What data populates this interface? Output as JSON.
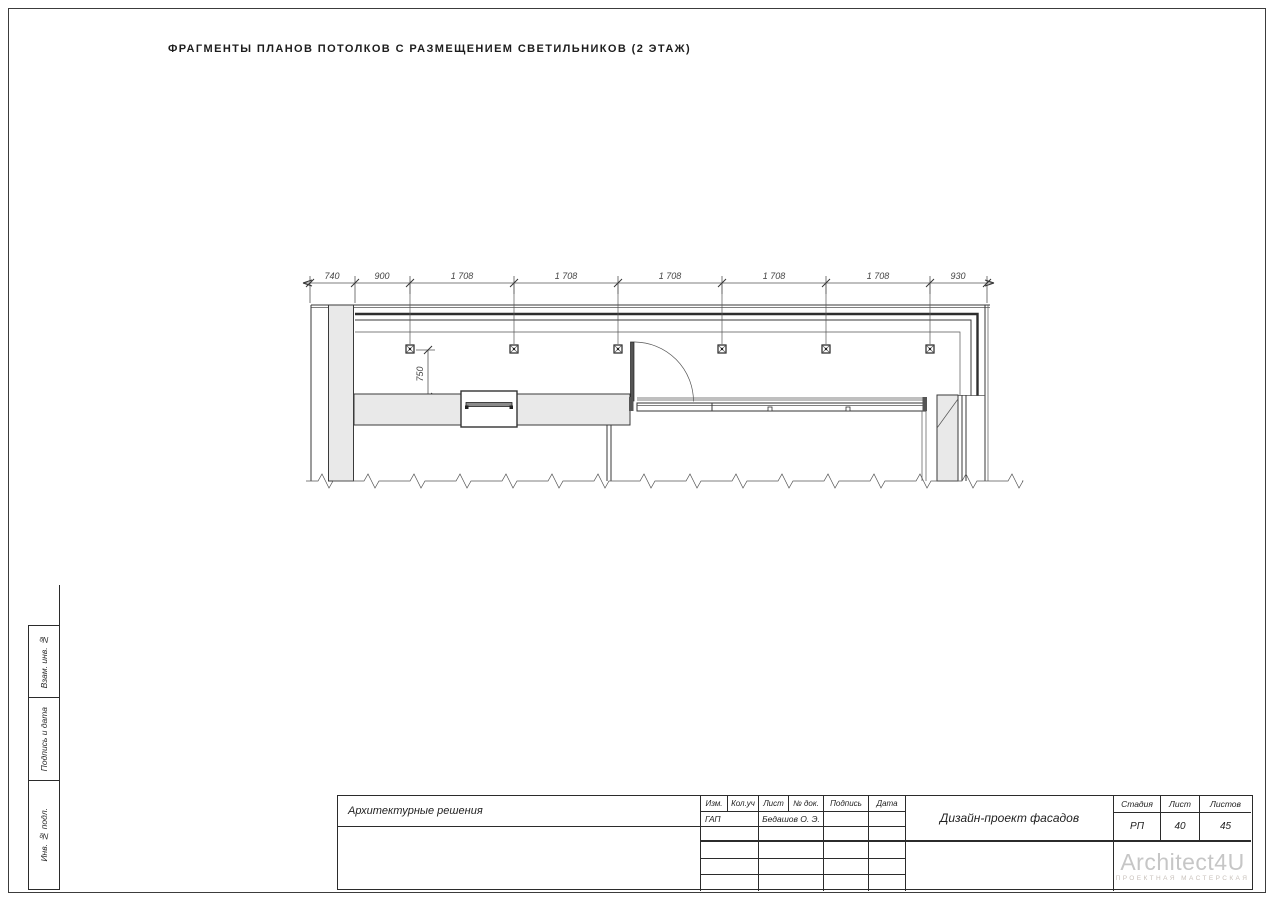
{
  "sheet": {
    "title": "ФРАГМЕНТЫ ПЛАНОВ ПОТОЛКОВ С РАЗМЕЩЕНИЕМ СВЕТИЛЬНИКОВ (2 ЭТАЖ)"
  },
  "drawing": {
    "dims_h": [
      "740",
      "900",
      "1 708",
      "1 708",
      "1 708",
      "1 708",
      "1 708",
      "930"
    ],
    "dim_v": "750",
    "light_fixture_count": 6
  },
  "side_stamp": {
    "labels": [
      "Взам. инв. №",
      "Подпись и дата",
      "Инв. № подл."
    ]
  },
  "title_block": {
    "section": "Архитектурные решения",
    "cols": [
      "Изм.",
      "Кол.уч",
      "Лист",
      "№ док.",
      "Подпись",
      "Дата"
    ],
    "role": "ГАП",
    "name": "Бедашов О. Э.",
    "project": "Дизайн-проект фасадов",
    "stage_h": "Стадия",
    "list_h": "Лист",
    "listov_h": "Листов",
    "stage": "РП",
    "list": "40",
    "listov": "45",
    "logo_name": "Architect4U",
    "logo_sub": "ПРОЕКТНАЯ МАСТЕРСКАЯ"
  }
}
